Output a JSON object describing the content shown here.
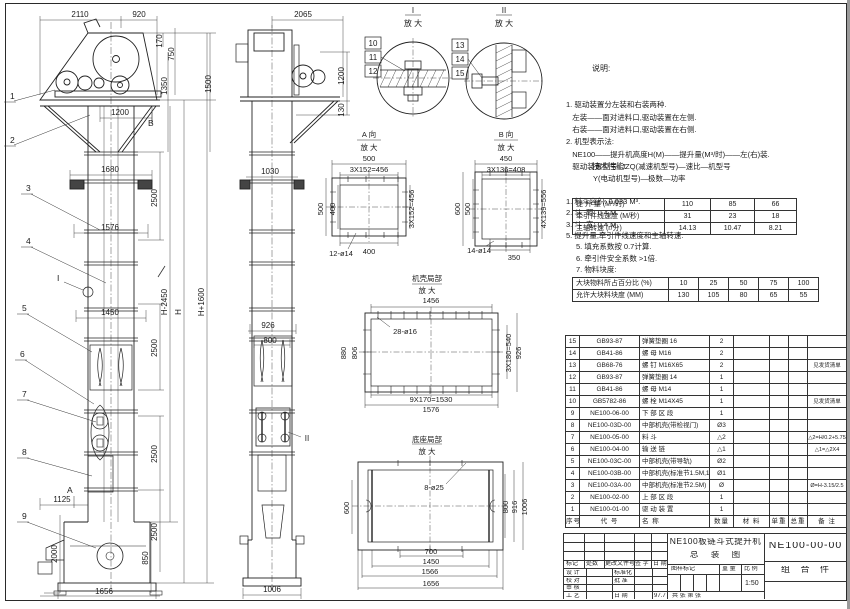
{
  "sheet": {
    "ink": "#1c1c1c",
    "paper": "#ffffff"
  },
  "dims": {
    "f2110": "2110",
    "f920": "920",
    "f170": "170",
    "f750": "750",
    "f1350": "1350",
    "f1500": "1500",
    "f1200": "1200",
    "f1680": "1680",
    "f2500a": "2500",
    "f1576": "1576",
    "fH2450": "H-2450",
    "fH": "H",
    "fH1600": "H+1600",
    "f1450": "1450",
    "f2500b": "2500",
    "f2500c": "2500",
    "f2500d": "2500",
    "f1125": "1125",
    "f2000": "2000",
    "f850": "850",
    "f1656": "1656",
    "s2065": "2065",
    "s1200": "1200",
    "s130": "130",
    "s1030": "1030",
    "s926": "926",
    "s800": "800",
    "s1006": "1006",
    "a500t": "500",
    "a456t": "3X152=456",
    "a500l": "500",
    "a400l": "400",
    "a456r": "3X152=456",
    "a400b": "400",
    "aholes": "12-ø14",
    "b450": "450",
    "b408": "3X136=408",
    "b600": "600",
    "b500": "500",
    "b556": "4X139=556",
    "b350": "350",
    "bholes": "14-ø14",
    "c1456": "1456",
    "choles": "28-ø16",
    "c880": "880",
    "c806": "806",
    "c540": "3X180=540",
    "c926": "926",
    "c1530": "9X170=1530",
    "c1576": "1576",
    "dholes": "8-ø25",
    "d600": "600",
    "d800": "800",
    "d916": "916",
    "d1006": "1006",
    "d700": "700",
    "d1450": "1450",
    "d1566": "1566",
    "d1656": "1656"
  },
  "balloons": {
    "b1": "1",
    "b2": "2",
    "b3": "3",
    "b4": "4",
    "b5": "5",
    "b6": "6",
    "b7": "7",
    "b8": "8",
    "b9": "9",
    "b10": "10",
    "b11": "11",
    "b12": "12",
    "b13": "13",
    "b14": "14",
    "b15": "15"
  },
  "markers": {
    "a": "A",
    "b": "B",
    "i": "I",
    "ii": "II"
  },
  "detail_titles": {
    "i": "I",
    "ii": "II",
    "zoom": "放 大",
    "a": "A 向",
    "b": "B 向",
    "casing": "机壳局部",
    "base": "底座局部"
  },
  "notes": {
    "heading": "说明:",
    "lines": [
      "1. 驱动装置分左装和右装两种.",
      "   左装——面对进料口,驱动装置在左侧.",
      "   右装——面对进料口,驱动装置在右侧.",
      "2. 机型表示法:",
      "   NE100——提升机高度H(M)——提升量(M³/时)——左(右)装.",
      "   驱动装置型号: JZQ(减速机型号)—速比—机型号",
      "             Y(电动机型号)—极数—功率"
    ]
  },
  "tech": {
    "heading": "技术性能:",
    "items": [
      "1. 料斗容积: 0.033 M³.",
      "2. 斗  距: 0.4 M.",
      "3. 斗  宽: 0.4 M.",
      "5. 提升量,牵引件线速度和主轴转速:"
    ],
    "table1_rows": [
      [
        "提 升 量 (M³/时)",
        "110",
        "85",
        "66"
      ],
      [
        "牵引件线速度 (M/秒)",
        "31",
        "23",
        "18"
      ],
      [
        "主轴转速 (r/分)",
        "14.13",
        "10.47",
        "8.21"
      ]
    ],
    "notes2": [
      "5. 填充系数按 0.7计算.",
      "6. 牵引件安全系数 >1倍.",
      "7. 物料块度:"
    ],
    "table2_rows": [
      [
        "大块物料所占百分比 (%)",
        "10",
        "25",
        "50",
        "75",
        "100"
      ],
      [
        "允许大块料块度 (MM)",
        "130",
        "105",
        "80",
        "65",
        "55"
      ]
    ]
  },
  "bom": {
    "headers": [
      "序号",
      "代  号",
      "名  称",
      "数量",
      "材  料",
      "单重",
      "总重",
      "备  注"
    ],
    "rows": [
      [
        "15",
        "GB93-87",
        "弹簧垫圈 16",
        "2",
        "",
        "",
        "",
        ""
      ],
      [
        "14",
        "GB41-86",
        "螺 母 M16",
        "2",
        "",
        "",
        "",
        ""
      ],
      [
        "13",
        "GB68-76",
        "螺 钉 M16X65",
        "2",
        "",
        "",
        "",
        "见发货清单"
      ],
      [
        "12",
        "GB93-87",
        "弹簧垫圈 14",
        "1",
        "",
        "",
        "",
        ""
      ],
      [
        "11",
        "GB41-86",
        "螺 母 M14",
        "1",
        "",
        "",
        "",
        ""
      ],
      [
        "10",
        "GB5782-86",
        "螺 栓 M14X45",
        "1",
        "",
        "",
        "",
        "见发货清单"
      ],
      [
        "9",
        "NE100-06-00",
        "下 部 区 段",
        "1",
        "",
        "",
        "",
        ""
      ],
      [
        "8",
        "NE100-03D-00",
        "中部机壳(带检视门)",
        "Ø3",
        "",
        "",
        "",
        ""
      ],
      [
        "7",
        "NE100-05-00",
        "料 斗",
        "△2",
        "",
        "",
        "",
        "△2=H/0.2+5.75"
      ],
      [
        "6",
        "NE100-04-00",
        "输 送 链",
        "△1",
        "",
        "",
        "",
        "△1=△2X4"
      ],
      [
        "5",
        "NE100-03C-00",
        "中部机壳(带导轨)",
        "Ø2",
        "",
        "",
        "",
        ""
      ],
      [
        "4",
        "NE100-03B-00",
        "中部机壳(标准节1.5M,1M)",
        "Ø1",
        "",
        "",
        "",
        ""
      ],
      [
        "3",
        "NE100-03A-00",
        "中部机壳(标准节2.5M)",
        "Ø",
        "",
        "",
        "",
        "Ø=H-3.15/2.5"
      ],
      [
        "2",
        "NE100-02-00",
        "上 部 区 段",
        "1",
        "",
        "",
        "",
        ""
      ],
      [
        "1",
        "NE100-01-00",
        "驱 动 装 置",
        "1",
        "",
        "",
        "",
        ""
      ]
    ]
  },
  "titleblock": {
    "rev": {
      "mark": "标记",
      "count": "处数",
      "doc": "更改文件号",
      "sign": "签 字",
      "date": "日 期"
    },
    "roles": {
      "design": "设 计",
      "check": "校 对",
      "review": "审 核",
      "craft": "工 艺",
      "std": "标准化",
      "approve": "批 准",
      "date_label": "日 期",
      "date_value": "97.7"
    },
    "title_line1": "NE100板链斗式提升机",
    "title_line2": "总 装 图",
    "stamp": {
      "mark": "图样标记",
      "weight": "重 量",
      "scale_label": "比 例",
      "scale": "1:50",
      "sheets": "共    张  第    张"
    },
    "drawing_no": "NE100-00-00",
    "part_type": "组 合 件"
  }
}
